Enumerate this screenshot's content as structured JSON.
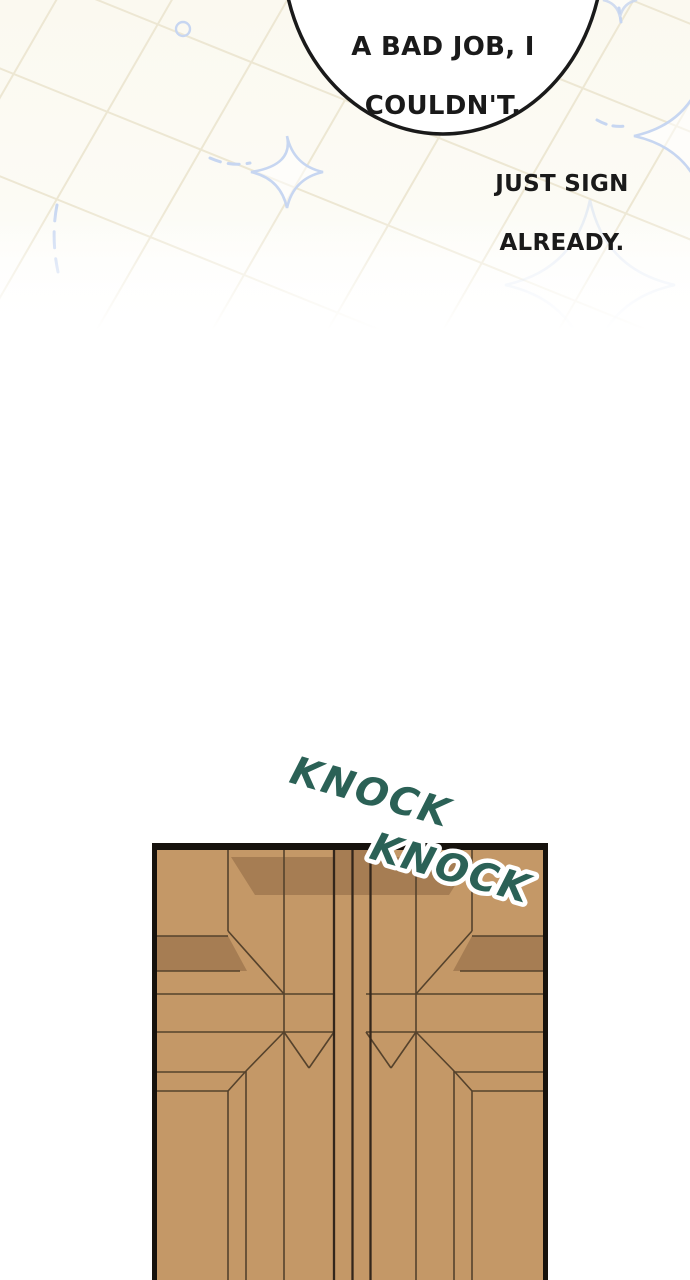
{
  "scene_description": "webtoon comic panel",
  "bubble": {
    "line1": "A BAD JOB, I",
    "line2": "COULDN'T."
  },
  "caption": {
    "line1": "JUST SIGN",
    "line2": "ALREADY."
  },
  "sfx": {
    "knock1": "KNOCK",
    "knock2": "KNOCK"
  },
  "decor_icons": {
    "sparkle": "sparkle-icon (4-point concave star)",
    "circle": "circle-outline-icon",
    "dashes": "motion-dash-icon"
  },
  "colors": {
    "ink": "#1A1A1A",
    "bg-cream": "#FBF9F0",
    "grid-line": "#EDE7D3",
    "sparkle-blue": "#C7D6F1",
    "sfx-teal": "#2B6156",
    "door-tan": "#C49867",
    "door-shade": "#A67D53",
    "door-line": "#55422C",
    "door-gap": "#33261B",
    "door-frame": "#16120D"
  }
}
